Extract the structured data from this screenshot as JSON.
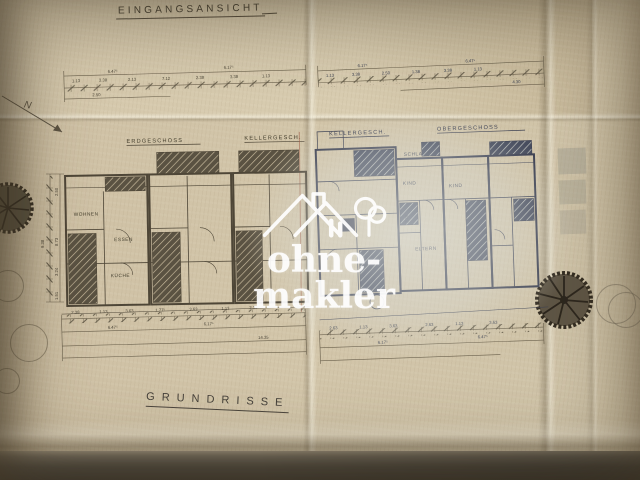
{
  "photo_titles": {
    "top": "EINGANGSANSICHT",
    "bottom": "GRUNDRISSE"
  },
  "watermark": {
    "text": "ohne-makler",
    "logo": "house-and-tree",
    "color": "#ffffff"
  },
  "compass": {
    "label": "N"
  },
  "floor_labels": {
    "erdgeschoss": "ERDGESCHOSS",
    "keller_left": "KELLERGESCH.",
    "keller_right": "KELLERGESCH.",
    "obergeschoss": "OBERGESCHOSS"
  },
  "rooms": {
    "wohnen": "WOHNEN",
    "essen": "ESSEN",
    "kueche": "KÜCHE",
    "schlafen": "SCHLAFEN",
    "kind_1": "KIND",
    "kind_2": "KIND",
    "eltern": "ELTERN"
  },
  "dims": {
    "top_left": [
      "6.47⁵",
      "6.17⁵",
      "1.13",
      "3.38",
      "2.13",
      "7.12",
      "2.38",
      "3.38",
      "1.13",
      "2.50"
    ],
    "top_right": [
      "6.17⁵",
      "6.47⁵",
      "1.13",
      "3.38",
      "2.50",
      "1.38",
      "3.38",
      "1.13",
      "4.30"
    ],
    "bottom_left": [
      "2.38",
      "1.13",
      "3.63",
      "1.77⁵",
      "3.63",
      "1.13",
      "2.38",
      "6.47⁵",
      "6.17⁵",
      "14.35"
    ],
    "bottom_right": [
      "2.63",
      "1.13",
      "3.63",
      "2.63",
      "1.13",
      "3.63",
      "6.17⁵",
      "6.47⁵"
    ],
    "left_vertical": [
      "2.50",
      "9.38",
      "8.73",
      "3.24",
      "1.51"
    ],
    "og_side": [
      "2.76"
    ]
  },
  "colors": {
    "paper": "#cdbfa3",
    "ink_left_sheet": "#4e4637",
    "ink_right_sheet": "#3d4152",
    "watermark": "#ffffff"
  }
}
